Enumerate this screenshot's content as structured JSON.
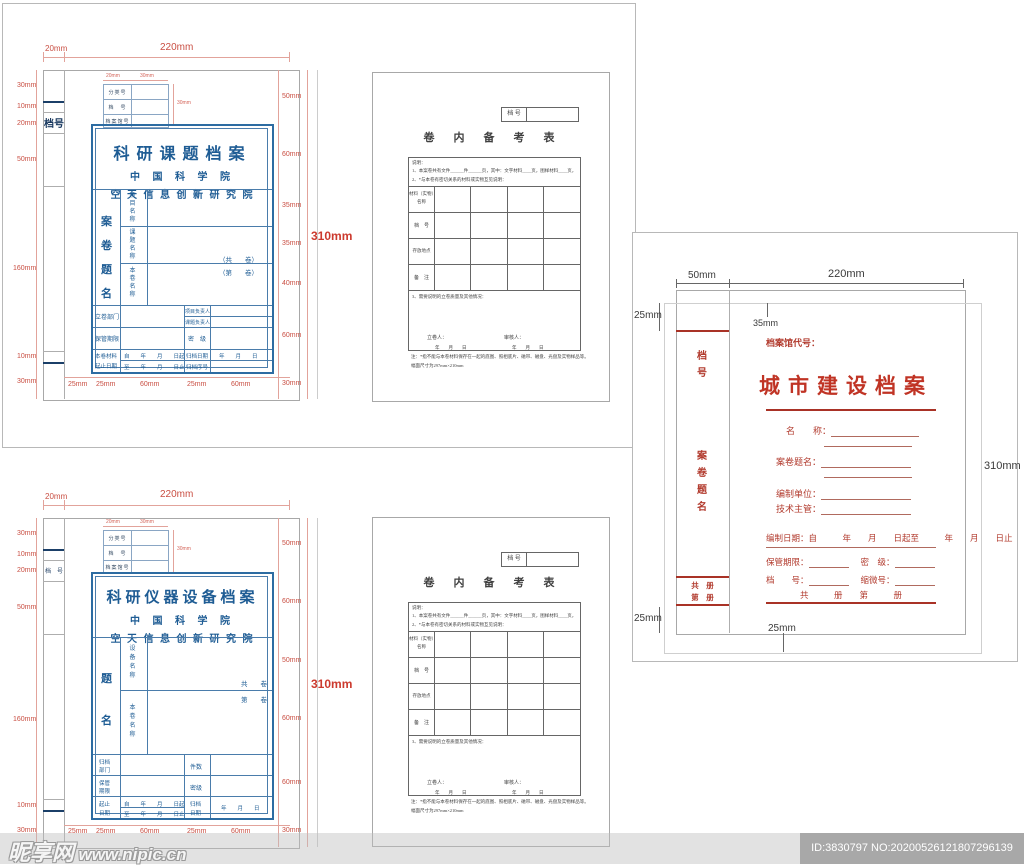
{
  "folder1": {
    "dim_top": [
      "20mm",
      "220mm"
    ],
    "dim_left": [
      "30mm",
      "10mm",
      "20mm",
      "50mm",
      "160mm",
      "10mm",
      "30mm"
    ],
    "dim_right": [
      "50mm",
      "60mm",
      "35mm",
      "35mm",
      "40mm",
      "60mm",
      "30mm"
    ],
    "dim_bottom": [
      "25mm",
      "25mm",
      "60mm",
      "25mm",
      "60mm"
    ],
    "dim_total": "310mm",
    "mini_dims": [
      "20mm",
      "30mm",
      "30mm"
    ],
    "mini_rows": [
      "分类号",
      "档　号",
      "档案馆号"
    ],
    "spine": "档号",
    "title": "科研课题档案",
    "org1": "中 国 科 学 院",
    "org2": "空 天 信 息 创 新 研 究 院",
    "side_col": "案卷题名",
    "row1": "项目名称",
    "row2": "课题名称",
    "row3": "本卷名称",
    "vol1": "（共　　卷）",
    "vol2": "（第　　卷）",
    "b_left1": "立卷部门",
    "b_r1a": "项目负责人",
    "b_r1b": "课题负责人",
    "b_left2": "保管期限",
    "b_r2": "密　级",
    "b_left3a": "本卷材料",
    "b_left3b": "起止日期",
    "b_from": "自　　年　　月　　日起",
    "b_to": "至　　年　　月　　日止",
    "b_r3a": "归档日期",
    "b_r3b": "归档序号",
    "b_date": "年　　月　　日"
  },
  "folder2": {
    "dim_top": [
      "20mm",
      "220mm"
    ],
    "dim_left": [
      "30mm",
      "10mm",
      "20mm",
      "50mm",
      "160mm",
      "10mm",
      "30mm"
    ],
    "dim_right": [
      "50mm",
      "60mm",
      "50mm",
      "60mm",
      "60mm",
      "30mm"
    ],
    "dim_bottom": [
      "25mm",
      "25mm",
      "60mm",
      "25mm",
      "60mm"
    ],
    "dim_total": "310mm",
    "mini_dims": [
      "20mm",
      "30mm",
      "30mm"
    ],
    "mini_rows": [
      "分类号",
      "档　号",
      "档案馆号"
    ],
    "spine": "档　号",
    "title": "科研仪器设备档案",
    "org1": "中 国 科 学 院",
    "org2": "空 天 信 息 创 新 研 究 院",
    "side_col": "题名",
    "row1": "设备名称",
    "row2": "本卷名称",
    "vol1": "共　　卷",
    "vol2": "第　　卷",
    "b_left1a": "归档",
    "b_left1b": "部门",
    "b_r1": "件数",
    "b_left2a": "保管",
    "b_left2b": "期限",
    "b_r2": "密级",
    "b_left3a": "起止",
    "b_left3b": "日期",
    "b_from": "自　　年　　月　　日起",
    "b_to": "至　　年　　月　　日止",
    "b_r3a": "归档",
    "b_r3b": "日期",
    "b_date": "年　　月　　日"
  },
  "beikao": {
    "dh_label": "档 号",
    "title": "卷　内　备　考　表",
    "s0": "说明：",
    "s1": "1、本案卷共有文件______件______页，其中：文字材料____页，图样材料____页，",
    "s2": "2、*与本卷有密切关系的材料或实物互见说明：",
    "r1a": "材料（实物）",
    "r1b": "名称",
    "r2": "档　号",
    "r3": "存放地点",
    "r4": "备　注",
    "s3": "3、需要说明的立卷质量及其他情况：",
    "sign1": "立卷人：",
    "sign2": "审核人：",
    "date1": "年　　月　　日",
    "date2": "年　　月　　日",
    "n1": "注：*指不能与本卷材料保存在一起的底图、照相底片、磁带、磁盘、光盘及实物样品等。",
    "n2": "幅面尺寸为297mm×210mm"
  },
  "rightp": {
    "dim_w1": "50mm",
    "dim_w2": "220mm",
    "dim_m1": "25mm",
    "dim_m2": "35mm",
    "dim_h": "310mm",
    "dim_m3": "25mm",
    "dim_m4": "25mm",
    "code": "档案馆代号：",
    "title": "城市建设档案",
    "spine_top": "档号",
    "spine_mid": "案卷题名",
    "spine_b1": "共　册",
    "spine_b2": "第　册",
    "f_name": "名　　称：",
    "f_title": "案卷题名：",
    "f_unit": "编制单位：",
    "f_tech": "技术主管：",
    "f_date": "编制日期：自　　　年　　月　　日起至　　　年　　月　　日止",
    "f_keep": "保管期限：",
    "f_secret": "密　级：",
    "f_no": "档　　号：",
    "f_micro": "缩微号：",
    "f_vol": "共　　　册　　第　　　册"
  },
  "watermark": {
    "site": "昵享网",
    "url": "www.nipic.cn",
    "id_text": "ID:3830797 NO:20200526121807296139"
  }
}
